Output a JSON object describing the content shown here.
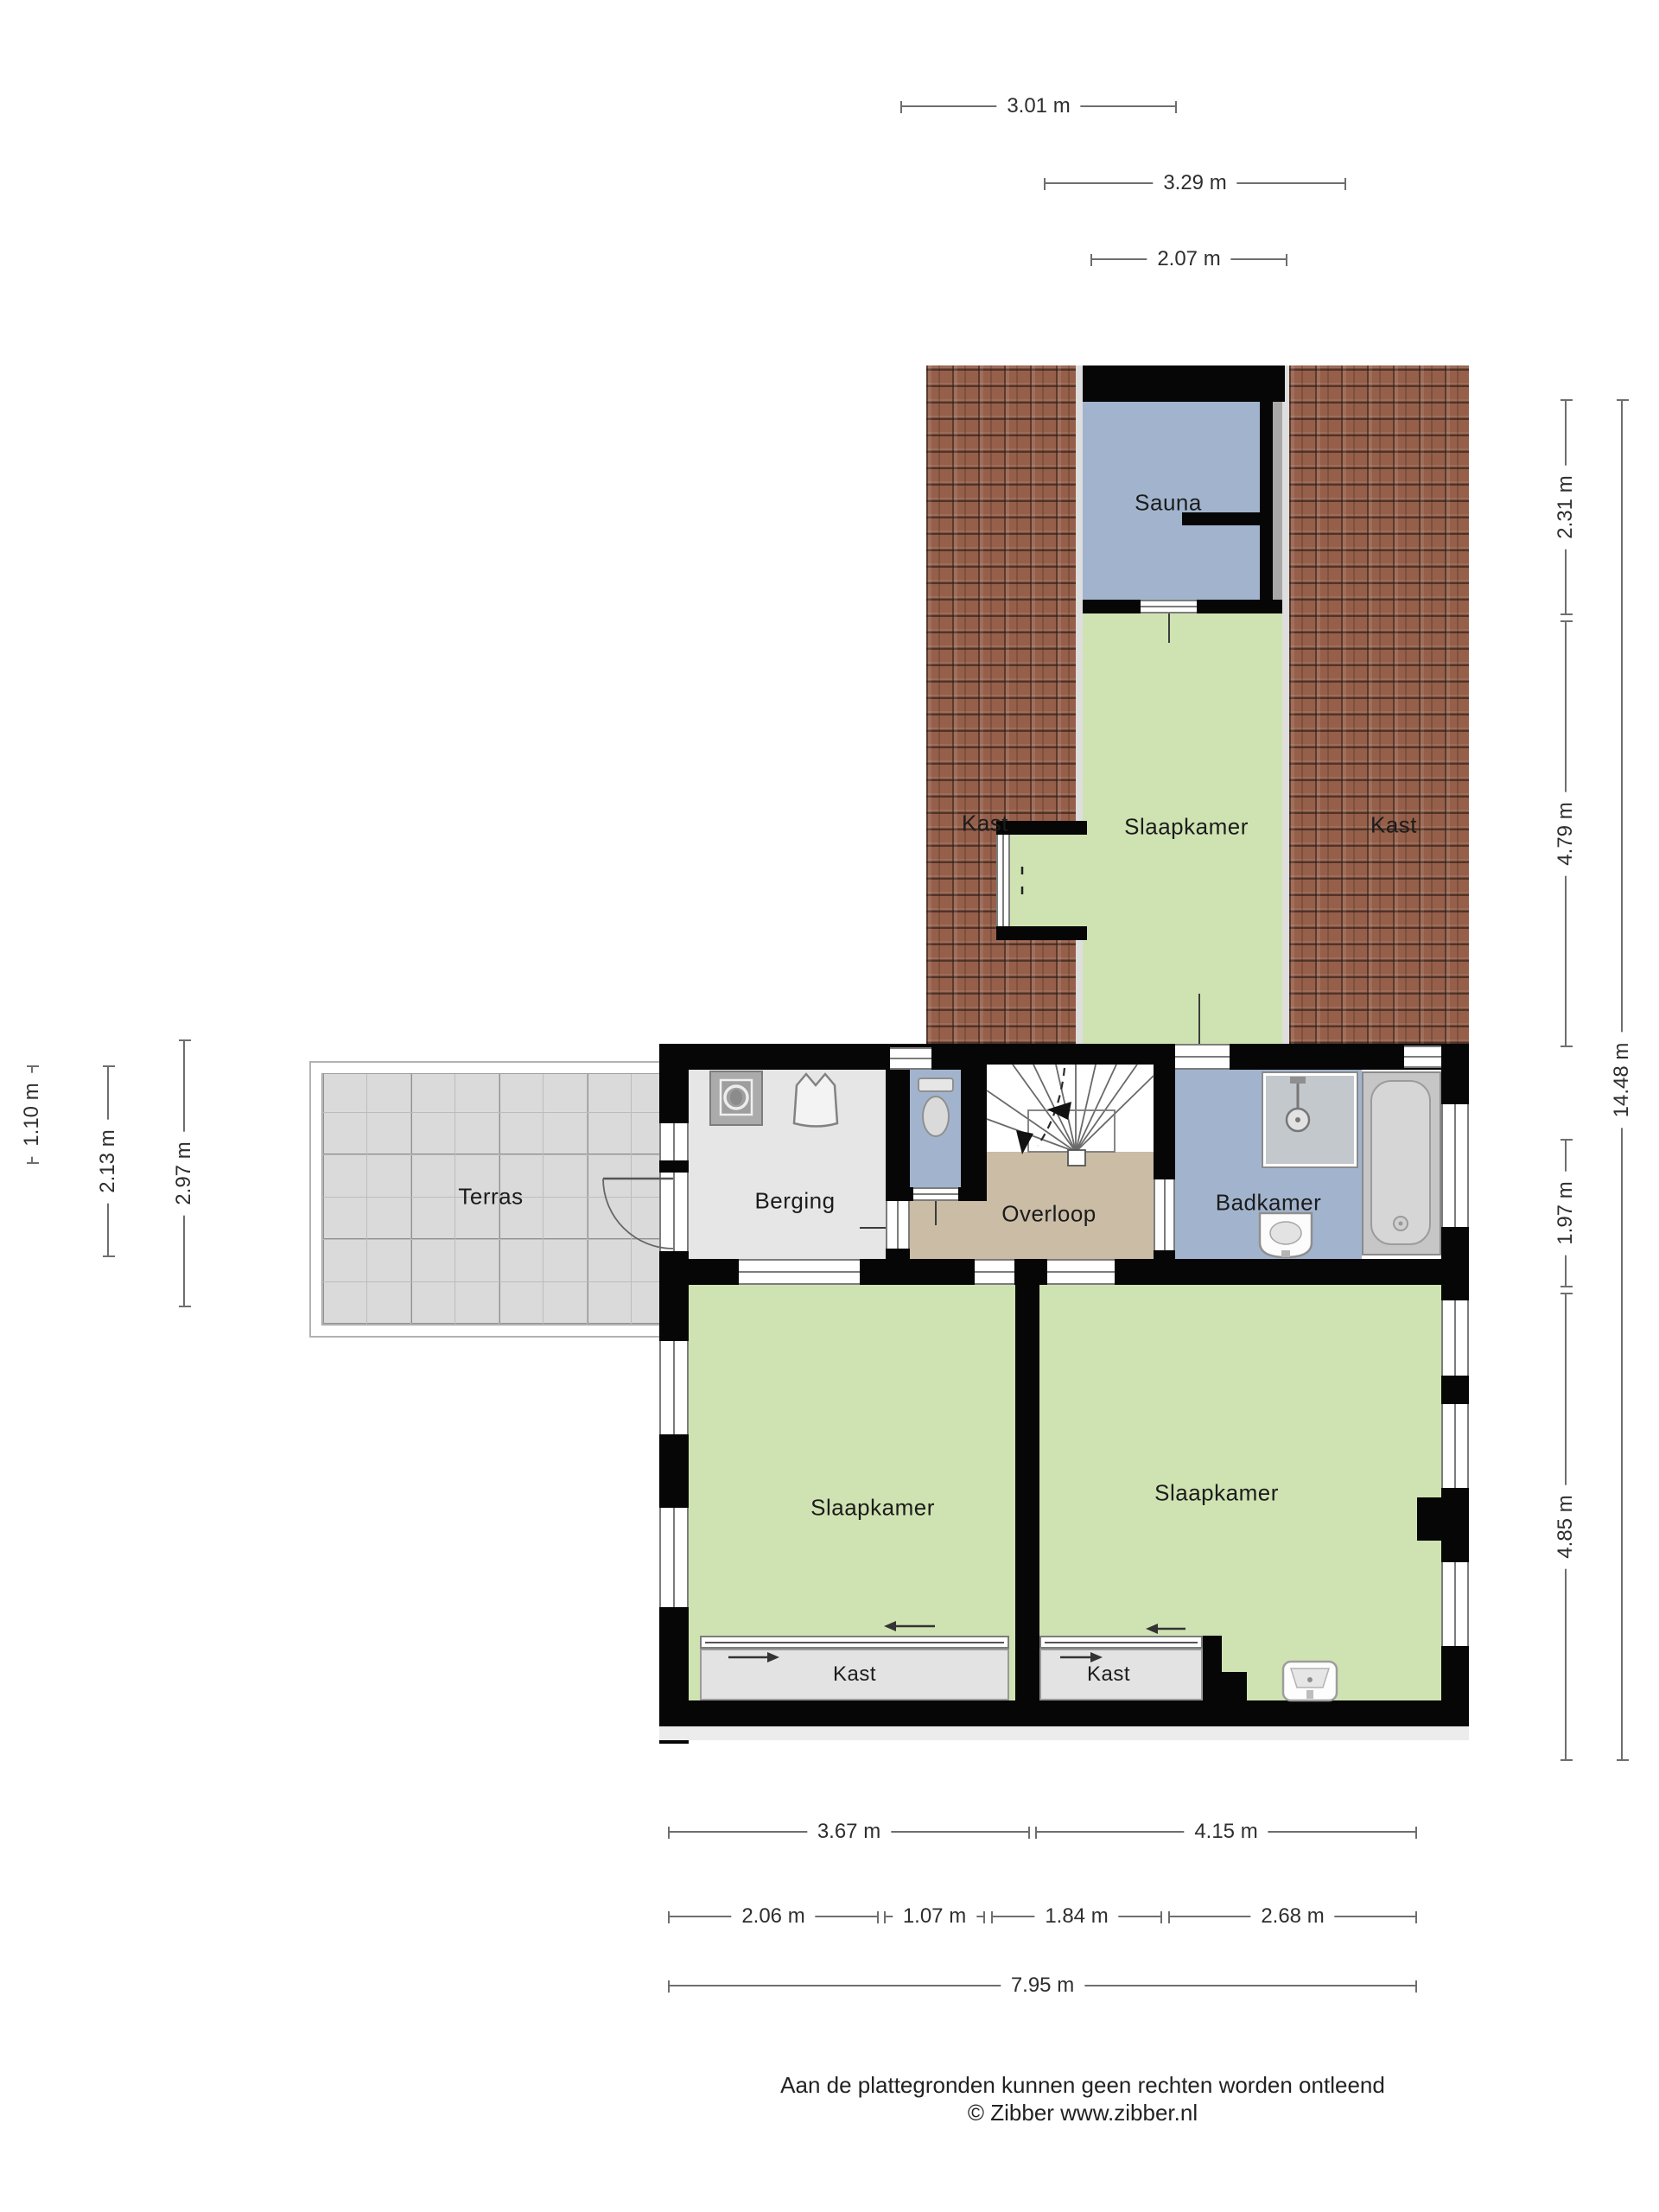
{
  "rooms": {
    "sauna": "Sauna",
    "bedroom_top": "Slaapkamer",
    "closet_top_left": "Kast",
    "closet_top_right": "Kast",
    "terrace": "Terras",
    "storage": "Berging",
    "landing": "Overloop",
    "bathroom": "Badkamer",
    "bedroom_left": "Slaapkamer",
    "bedroom_right": "Slaapkamer",
    "closet_bottom_left": "Kast",
    "closet_bottom_right": "Kast"
  },
  "dimensions": {
    "top": [
      "3.01 m",
      "3.29 m",
      "2.07 m"
    ],
    "right": [
      "2.31 m",
      "4.79 m",
      "1.97 m",
      "4.85 m",
      "14.48 m"
    ],
    "left": [
      "1.10 m",
      "2.13 m",
      "2.97 m"
    ],
    "bottom": [
      "3.67 m",
      "4.15 m",
      "2.06 m",
      "1.07 m",
      "1.84 m",
      "2.68 m",
      "7.95 m"
    ]
  },
  "footer": {
    "line1": "Aan de plattegronden kunnen geen rechten worden ontleend",
    "line2": "© Zibber www.zibber.nl"
  },
  "colors": {
    "wall": "#060606",
    "bedroom_green": "#cfe3b2",
    "wet_blue": "#a2b4cd",
    "landing_tan": "#cbbca6",
    "storage_gray": "#e6e6e6",
    "terrace_gray": "#dadada",
    "roof_base": "#955f4a",
    "closet_gray": "#e3e3e3"
  }
}
